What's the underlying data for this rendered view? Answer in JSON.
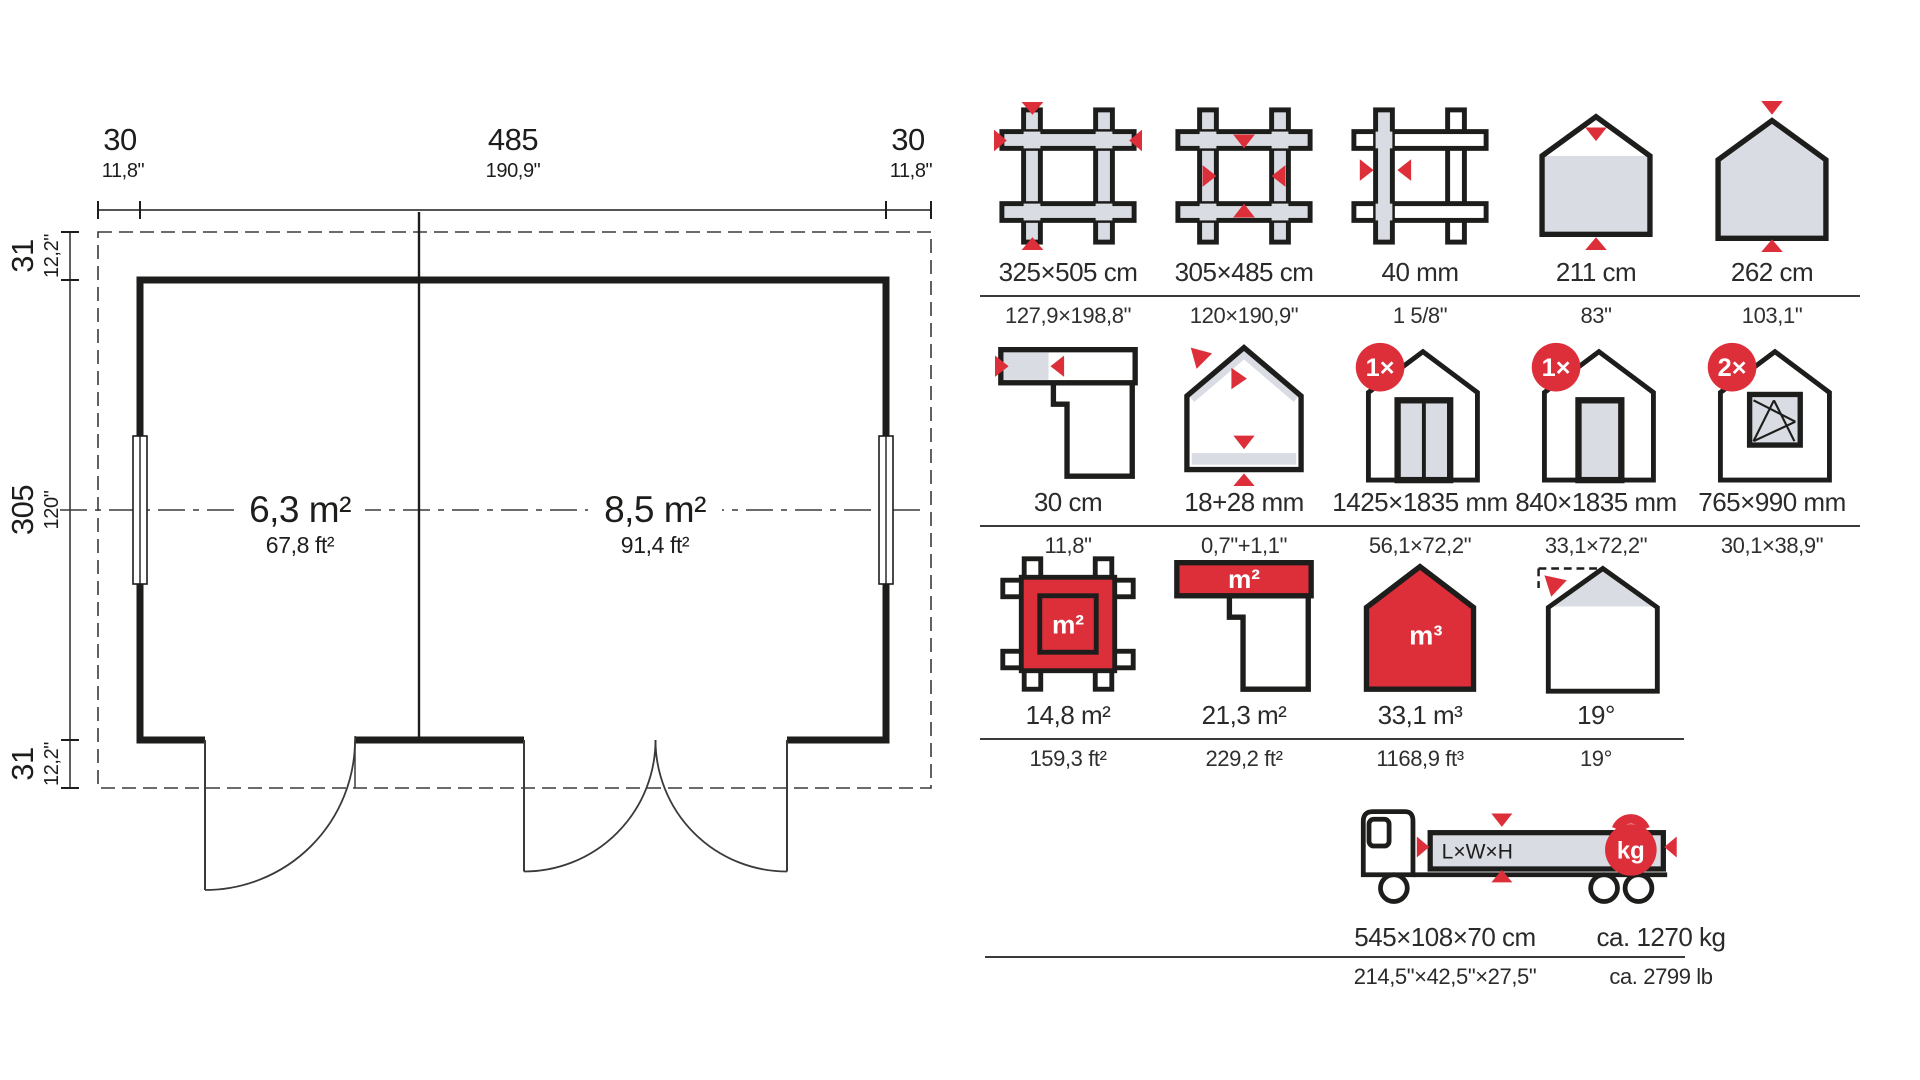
{
  "colors": {
    "accent": "#dd2f3a",
    "gray_fill": "#d9dde3",
    "line": "#1d1d1b",
    "text": "#2a2a2a"
  },
  "floor_plan": {
    "width_breakdown": {
      "left_overhang_cm": "30",
      "left_overhang_in": "11,8\"",
      "width_cm": "485",
      "width_in": "190,9\"",
      "right_overhang_cm": "30",
      "right_overhang_in": "11,8\""
    },
    "depth_breakdown": {
      "top_overhang_cm": "31",
      "top_overhang_in": "12,2\"",
      "depth_cm": "305",
      "depth_in": "120\"",
      "bottom_overhang_cm": "31",
      "bottom_overhang_in": "12,2\""
    },
    "rooms": [
      {
        "area_metric": "6,3 m²",
        "area_imperial": "67,8 ft²"
      },
      {
        "area_metric": "8,5 m²",
        "area_imperial": "91,4 ft²"
      }
    ]
  },
  "spec_grid": {
    "rows": [
      {
        "items": [
          {
            "icon": "log-frame-outer-size-icon",
            "metric": "325×505 cm",
            "imperial": "127,9×198,8\""
          },
          {
            "icon": "log-frame-inner-size-icon",
            "metric": "305×485 cm",
            "imperial": "120×190,9\""
          },
          {
            "icon": "wall-thickness-icon",
            "metric": "40 mm",
            "imperial": "1 5/8\""
          },
          {
            "icon": "eaves-height-icon",
            "metric": "211 cm",
            "imperial": "83\""
          },
          {
            "icon": "ridge-height-icon",
            "metric": "262 cm",
            "imperial": "103,1\""
          }
        ]
      },
      {
        "items": [
          {
            "icon": "roof-overhang-icon",
            "metric": "30 cm",
            "imperial": "11,8\""
          },
          {
            "icon": "roof-floor-thickness-icon",
            "metric": "18+28 mm",
            "imperial": "0,7\"+1,1\""
          },
          {
            "icon": "double-door-icon",
            "badge": "1×",
            "metric": "1425×1835 mm",
            "imperial": "56,1×72,2\""
          },
          {
            "icon": "single-door-icon",
            "badge": "1×",
            "metric": "840×1835 mm",
            "imperial": "33,1×72,2\""
          },
          {
            "icon": "window-icon",
            "badge": "2×",
            "metric": "765×990 mm",
            "imperial": "30,1×38,9\""
          }
        ]
      },
      {
        "items": [
          {
            "icon": "floor-area-icon",
            "label": "m²",
            "metric": "14,8 m²",
            "imperial": "159,3 ft²"
          },
          {
            "icon": "roof-area-icon",
            "label": "m²",
            "metric": "21,3 m²",
            "imperial": "229,2 ft²"
          },
          {
            "icon": "volume-icon",
            "label": "m³",
            "metric": "33,1 m³",
            "imperial": "1168,9 ft³"
          },
          {
            "icon": "roof-pitch-icon",
            "metric": "19°",
            "imperial": "19°"
          }
        ]
      }
    ],
    "transport": {
      "icon": "truck-icon",
      "cargo_label": "L×W×H",
      "weight_badge": "kg",
      "size_metric": "545×108×70 cm",
      "weight_metric": "ca. 1270 kg",
      "size_imperial": "214,5\"×42,5\"×27,5\"",
      "weight_imperial": "ca. 2799 lb"
    }
  }
}
